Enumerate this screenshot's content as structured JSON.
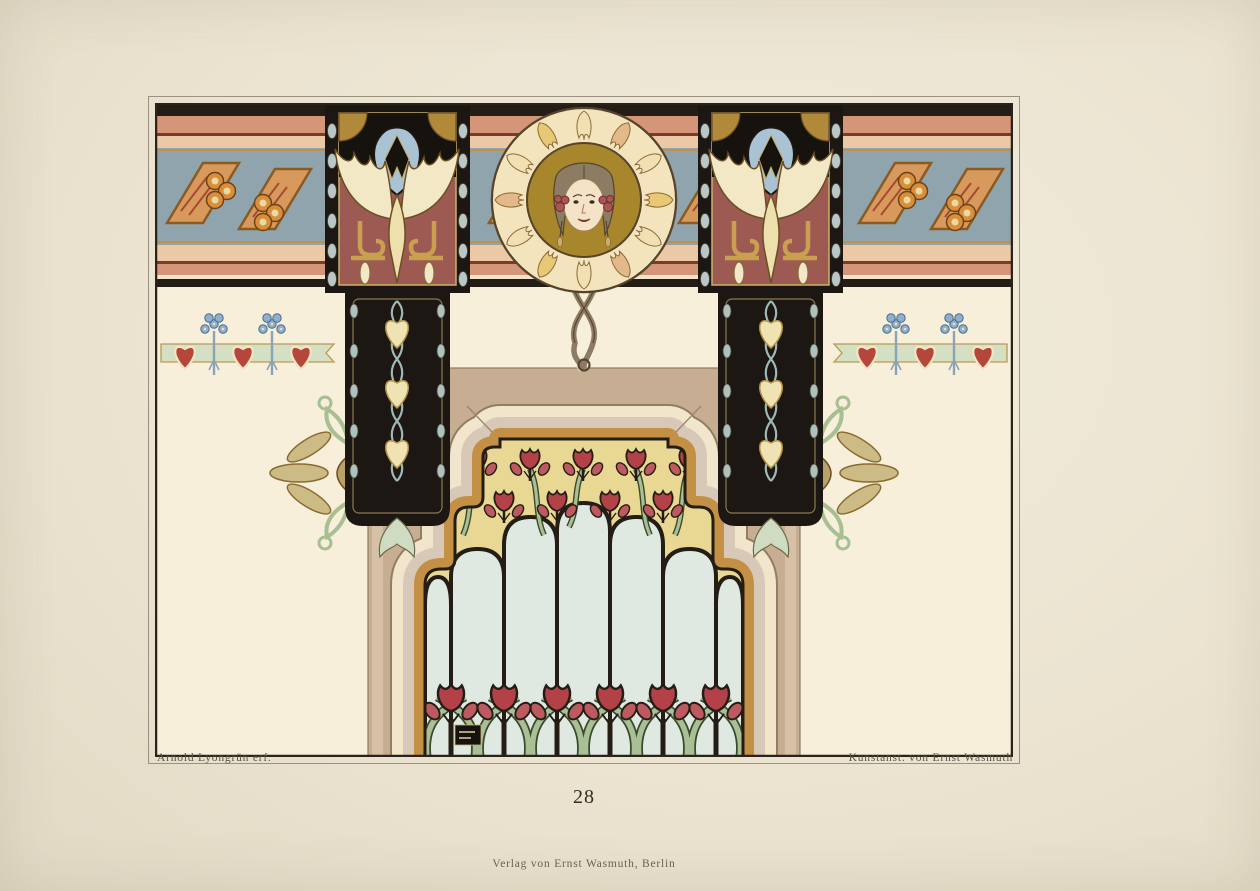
{
  "page": {
    "plate_number": "28",
    "caption_left": "Arnold Lyongrün erf.",
    "caption_right": "Kunstanst. von Ernst Wasmuth",
    "imprint": "Verlag von Ernst Wasmuth, Berlin"
  },
  "artwork": {
    "description": "Art Nouveau (Jugendstil) wall decoration design: top ornamental frieze with stylized orange berries and gold ribbon bands on slate blue, a central portrait medallion of a woman with flowing hair on a gold disc in a leaf wreath, two black pilasters with winged motifs on crimson panels and heart-leaf chains, a border of red hearts with blue flower clusters on a green ribbon, and a stepped doorway arch with a stained-glass panel of red tulips on green stems.",
    "elements": {
      "frieze": "berry-and-ribbon frieze band",
      "medallion": "woman portrait medallion with hair ribbons",
      "pilaster_left": "winged pilaster with heart-leaf chain",
      "pilaster_right": "winged pilaster with heart-leaf chain (mirrored)",
      "heart_border": "red hearts and blue flower clusters on green ribbon",
      "doorway": "stepped arch doorway with tan surround and cream molding",
      "glass": "stained-glass tulip panel",
      "sprays": "gold palmette sprays flanking the arch",
      "monogram": "illegible artist monogram block in lower left of glass"
    },
    "palette": {
      "paper": "#ece4d1",
      "wall_cream": "#f7efda",
      "salmon": "#d49579",
      "peach": "#ecc9a6",
      "slate_blue": "#8fa4ad",
      "ink_black": "#241d15",
      "crimson_panel": "#9c5a53",
      "gold": "#c49045",
      "olive_gold_disc": "#a8862c",
      "heart_red": "#b5463c",
      "tulip_red": "#b34248",
      "leaf_green": "#a9c096",
      "glass_blue": "#dfe9e2",
      "glass_yellow": "#e9d893",
      "tan_wall": "#c7ad92"
    }
  }
}
